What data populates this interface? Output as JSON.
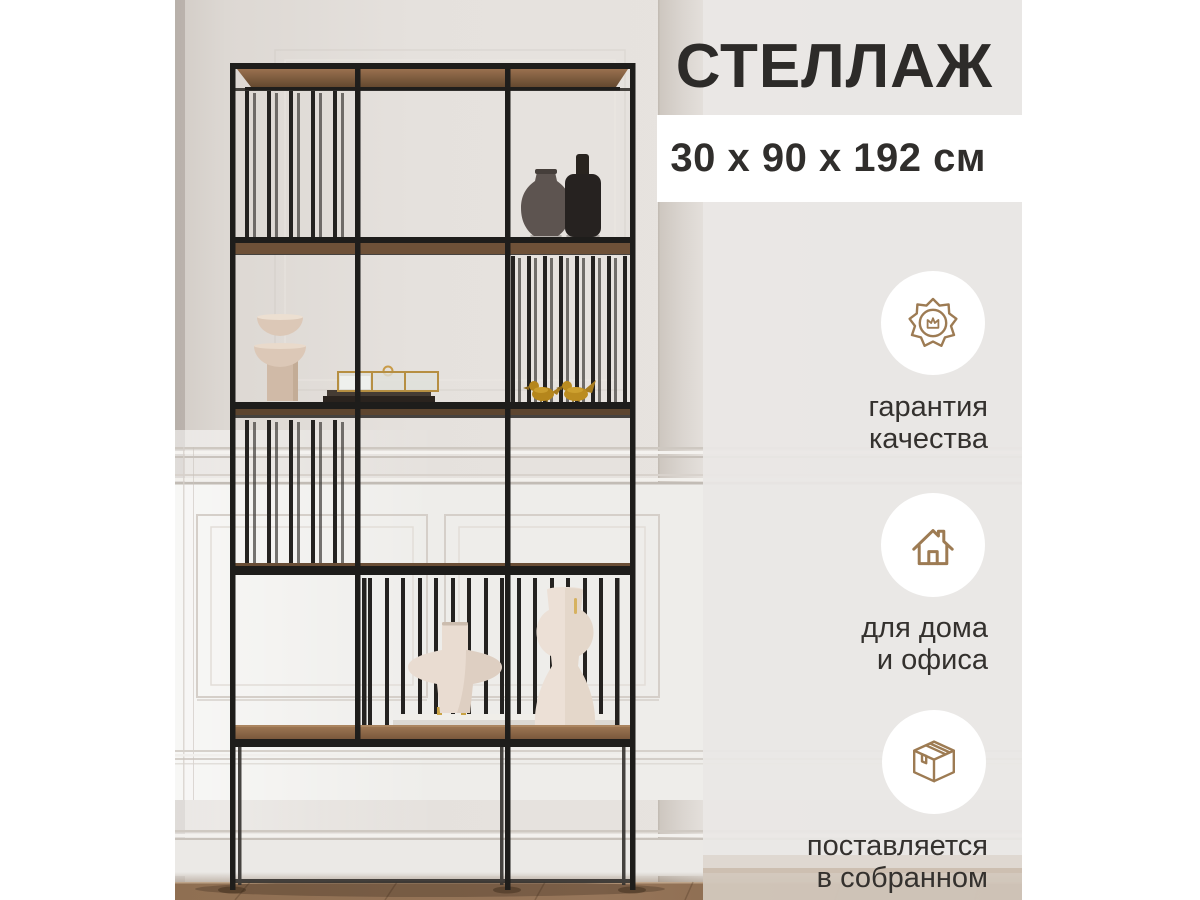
{
  "product_card": {
    "title": "СТЕЛЛАЖ",
    "dimensions": "30 х 90 х 192 см"
  },
  "features": [
    {
      "icon": "quality-seal-icon",
      "lines": [
        "гарантия",
        "качества"
      ]
    },
    {
      "icon": "house-icon",
      "lines": [
        "для дома",
        "и офиса"
      ]
    },
    {
      "icon": "package-box-icon",
      "lines": [
        "поставляется",
        "в собранном"
      ]
    }
  ],
  "photo": {
    "subject": "black metal shelving unit with wood shelves and decor vases in a room with paneled wall and wood floor"
  },
  "colors": {
    "accent_brown": "#9d7b53",
    "text_dark": "#2d2b29",
    "frost_panel": "#e9e7e5",
    "band_white": "#ffffff",
    "metal_black": "#1e1d1b",
    "shelf_wood": "#8a6748",
    "floor_wood": "#8f6f52"
  }
}
